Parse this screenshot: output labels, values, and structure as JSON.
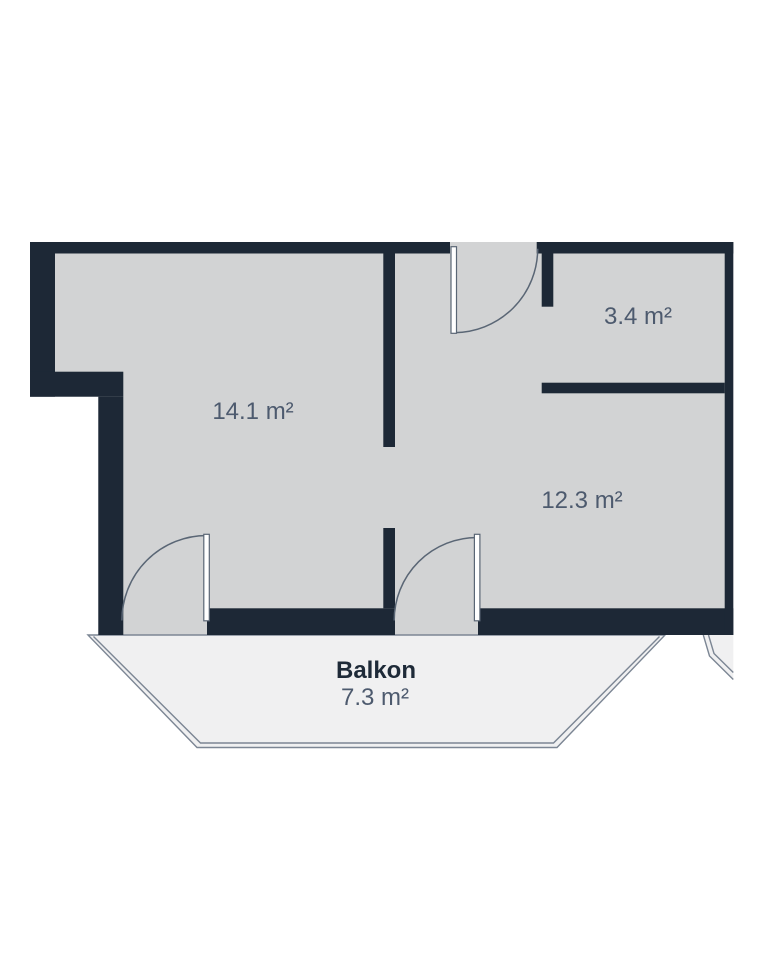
{
  "floorplan": {
    "rooms": [
      {
        "id": "room-large",
        "area_label": "14.1 m²"
      },
      {
        "id": "room-small",
        "area_label": "3.4 m²"
      },
      {
        "id": "room-medium",
        "area_label": "12.3 m²"
      }
    ],
    "balcony": {
      "label": "Balkon",
      "area_label": "7.3 m²"
    },
    "colors": {
      "wall": "#1d2836",
      "room-fill": "#d2d3d4",
      "balcony-fill": "#f0f0f1",
      "outline": "#7c8694",
      "door": "#5a6675",
      "label": "#4d5a6e",
      "label-dark": "#1e2a38"
    }
  }
}
